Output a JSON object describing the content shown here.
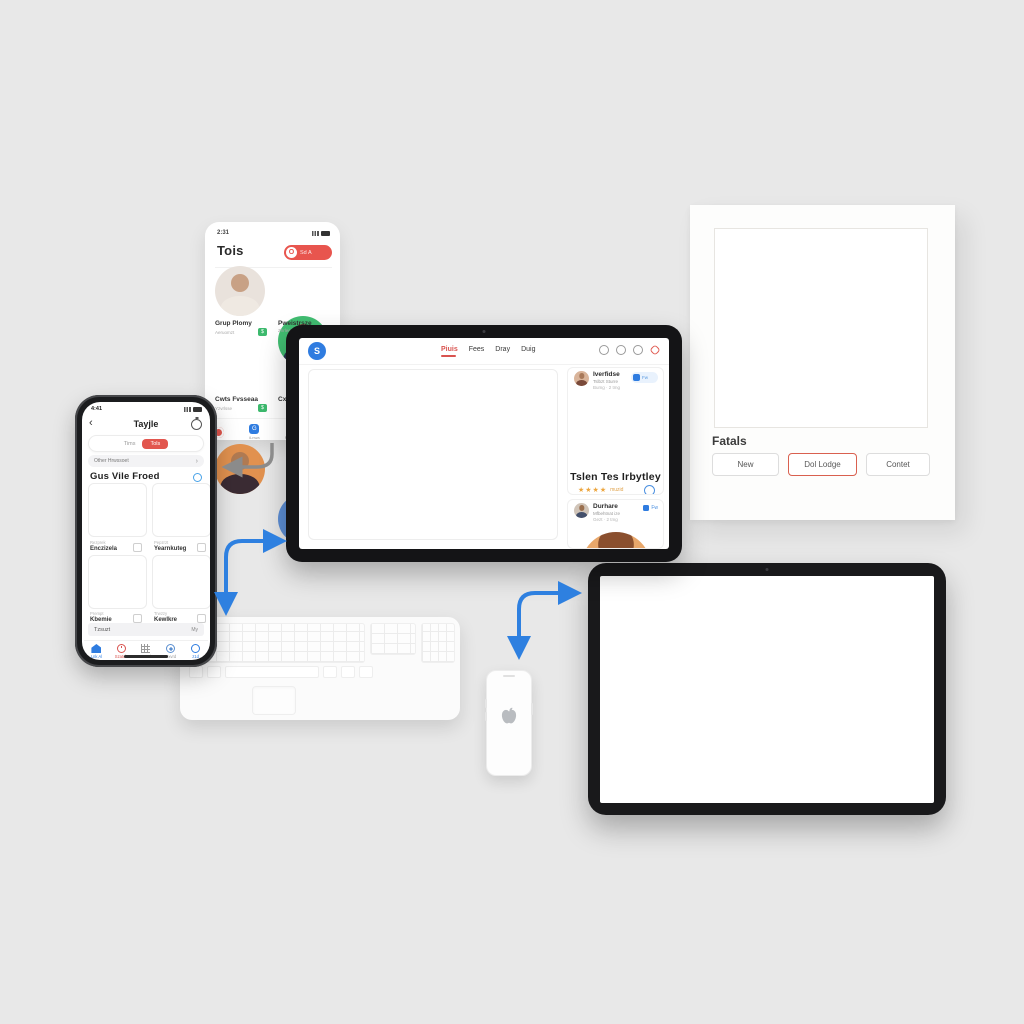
{
  "scene": {
    "background": "#e8e8e8",
    "accent_blue": "#2e80e0",
    "accent_red": "#e2564e"
  },
  "contact_card": {
    "status_time": "2:31",
    "title": "Tois",
    "action_button": {
      "circle_glyph": "O",
      "label": "Sd A"
    },
    "contacts": [
      {
        "name": "Grup Plomy",
        "subtitle": "Aeruomzt",
        "badge": "$"
      },
      {
        "name": "Pweistrsze",
        "subtitle": "Zhrlee",
        "badge": ""
      },
      {
        "name": "Cwts Fvsseaa",
        "subtitle": "Yzvrlsse",
        "badge": "$"
      },
      {
        "name": "Cxo",
        "subtitle": "",
        "badge": ""
      }
    ],
    "tab_labels": {
      "chat": "iLnwa",
      "browse": "FuChsn"
    }
  },
  "phone": {
    "status_time": "4:41",
    "back_glyph": "‹",
    "nav_title": "Tayjle",
    "segmented": {
      "inactive": "Tims",
      "active": "Tols"
    },
    "list_row": {
      "label": "Other Hrwssoet",
      "chevron": "›"
    },
    "section_title": "Gus Vile Froed",
    "grid_cards": [
      {
        "tag": "Rezprek",
        "name": "Enczizela"
      },
      {
        "tag": "Pepzrzt",
        "name": "Yearnkuteg"
      },
      {
        "tag": "Prempt",
        "name": "Kbemie"
      },
      {
        "tag": "Trwzzy",
        "name": "Kewlkre"
      }
    ],
    "footer_bar": {
      "label": "Tzsuzt",
      "action": "My"
    },
    "tabs": [
      {
        "label": "Lnk Al"
      },
      {
        "label": "Szatch"
      },
      {
        "label": "Vezxela"
      },
      {
        "label": "Dxvrd"
      },
      {
        "label": "z1d"
      }
    ]
  },
  "tablet": {
    "logo_glyph": "S",
    "nav_items": [
      {
        "label": "Piuis"
      },
      {
        "label": "Fees"
      },
      {
        "label": "Dray"
      },
      {
        "label": "Duig"
      }
    ],
    "sidebar": {
      "profile_top": {
        "name": "Iverfidse",
        "subtitle": "Tslbzt Sturre",
        "meta": "Bumg · 2 tmg",
        "action": "Fw"
      },
      "featured": {
        "name": "Tslen Tes Irbytley",
        "stars": "★★★★",
        "rating_text": "muzid"
      },
      "profile_bottom": {
        "name": "Durhare",
        "subtitle": "Mfbehtnat ize",
        "meta": "Gezt · 2 tmg",
        "action": "Fw"
      }
    }
  },
  "paper": {
    "label": "Fatals",
    "buttons": [
      {
        "label": "New"
      },
      {
        "label": "Dol Lodge",
        "accent": "#d9604f"
      },
      {
        "label": "Contet"
      }
    ]
  },
  "icons": {
    "apple_logo": "apple",
    "back_chevron": "‹",
    "forward_chevron": "›",
    "star": "★"
  }
}
